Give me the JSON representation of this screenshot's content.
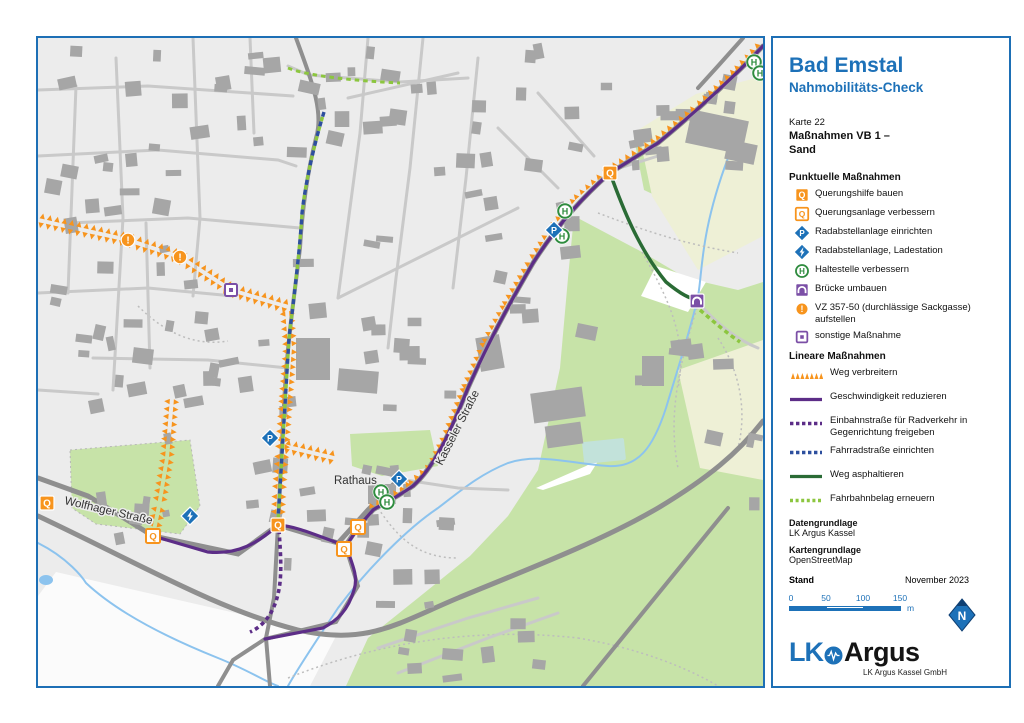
{
  "panel": {
    "title": "Bad Emstal",
    "subtitle": "Nahmobilitäts-Check",
    "map_number": "Karte 22",
    "map_title": "Maßnahmen VB 1 –\nSand",
    "point_measures_heading": "Punktuelle Maßnahmen",
    "point_measures": [
      {
        "icon": "q-filled-icon",
        "label": "Querungshilfe bauen"
      },
      {
        "icon": "q-outline-icon",
        "label": "Querungsanlage verbessern"
      },
      {
        "icon": "bike-parking-icon",
        "label": "Radabstellanlage einrichten"
      },
      {
        "icon": "bike-charging-icon",
        "label": "Radabstellanlage, Ladestation"
      },
      {
        "icon": "bus-stop-icon",
        "label": "Haltestelle verbessern"
      },
      {
        "icon": "bridge-icon",
        "label": "Brücke umbauen"
      },
      {
        "icon": "dead-end-sign-icon",
        "label": "VZ 357-50 (durchlässige Sackgasse) aufstellen"
      },
      {
        "icon": "misc-measure-icon",
        "label": "sonstige Maßnahme"
      }
    ],
    "linear_measures_heading": "Lineare Maßnahmen",
    "linear_measures": [
      {
        "style": "orange-triangles",
        "label": "Weg verbreitern"
      },
      {
        "style": "purple-solid",
        "label": "Geschwindigkeit reduzieren"
      },
      {
        "style": "purple-dashed",
        "label": "Einbahnstraße für Radverkehr in Gegenrichtung freigeben"
      },
      {
        "style": "blue-dashed",
        "label": "Fahrradstraße einrichten"
      },
      {
        "style": "green-solid",
        "label": "Weg asphaltieren"
      },
      {
        "style": "lightgreen-dashed",
        "label": "Fahrbahnbelag erneuern"
      }
    ],
    "data_source_heading": "Datengrundlage",
    "data_source": "LK Argus Kassel",
    "base_map_heading": "Kartengrundlage",
    "base_map": "OpenStreetMap",
    "date_heading": "Stand",
    "date_value": "November 2023",
    "scale": {
      "ticks": [
        "0",
        "50",
        "100",
        "150"
      ],
      "unit": "m"
    },
    "north_label": "N",
    "logo": {
      "lk": "LK",
      "argus": "Argus",
      "company": "LK Argus Kassel GmbH"
    },
    "address_line1": "Querallee 36 · D-34119 Kassel",
    "address_line2": "Tel. 0561.31 09 72 80 · Fax 0561.31 09 72 89",
    "address_line3": "kassel@lk-argus.de · www.lk-argus-kassel.de"
  },
  "map": {
    "labels": [
      {
        "text": "Wolfhager Straße",
        "x": 26,
        "y": 466,
        "rotate": 13
      },
      {
        "text": "Kasseler Straße",
        "x": 404,
        "y": 428,
        "rotate": -63
      },
      {
        "text": "Rathaus",
        "x": 296,
        "y": 446,
        "rotate": 0
      }
    ],
    "markers": [
      {
        "type": "bus-stop-icon",
        "x": 716,
        "y": 24
      },
      {
        "type": "bus-stop-icon",
        "x": 722,
        "y": 35
      },
      {
        "type": "q-filled-icon",
        "x": 572,
        "y": 135
      },
      {
        "type": "bus-stop-icon",
        "x": 527,
        "y": 173
      },
      {
        "type": "bus-stop-icon",
        "x": 524,
        "y": 198
      },
      {
        "type": "bike-parking-icon",
        "x": 516,
        "y": 192
      },
      {
        "type": "bridge-icon",
        "x": 659,
        "y": 263
      },
      {
        "type": "dead-end-sign-icon",
        "x": 90,
        "y": 202
      },
      {
        "type": "dead-end-sign-icon",
        "x": 142,
        "y": 219
      },
      {
        "type": "misc-measure-icon",
        "x": 193,
        "y": 252
      },
      {
        "type": "bike-parking-icon",
        "x": 232,
        "y": 400
      },
      {
        "type": "bike-charging-icon",
        "x": 152,
        "y": 478
      },
      {
        "type": "q-filled-icon",
        "x": 9,
        "y": 465
      },
      {
        "type": "q-outline-icon",
        "x": 115,
        "y": 498
      },
      {
        "type": "q-filled-icon",
        "x": 240,
        "y": 487
      },
      {
        "type": "q-outline-icon",
        "x": 320,
        "y": 489
      },
      {
        "type": "q-outline-icon",
        "x": 306,
        "y": 511
      },
      {
        "type": "bike-parking-icon",
        "x": 361,
        "y": 441
      },
      {
        "type": "bus-stop-icon",
        "x": 343,
        "y": 454
      },
      {
        "type": "bus-stop-icon",
        "x": 349,
        "y": 464
      }
    ]
  },
  "colors": {
    "accent_blue": "#1d71b8",
    "orange": "#f7941d",
    "purple": "#5c2d87",
    "blue_line": "#2d4f9e",
    "dark_green": "#2a6b35",
    "light_green": "#8cc63f",
    "h_green": "#2f8c3f",
    "bridge_purple": "#7b4fa6"
  }
}
